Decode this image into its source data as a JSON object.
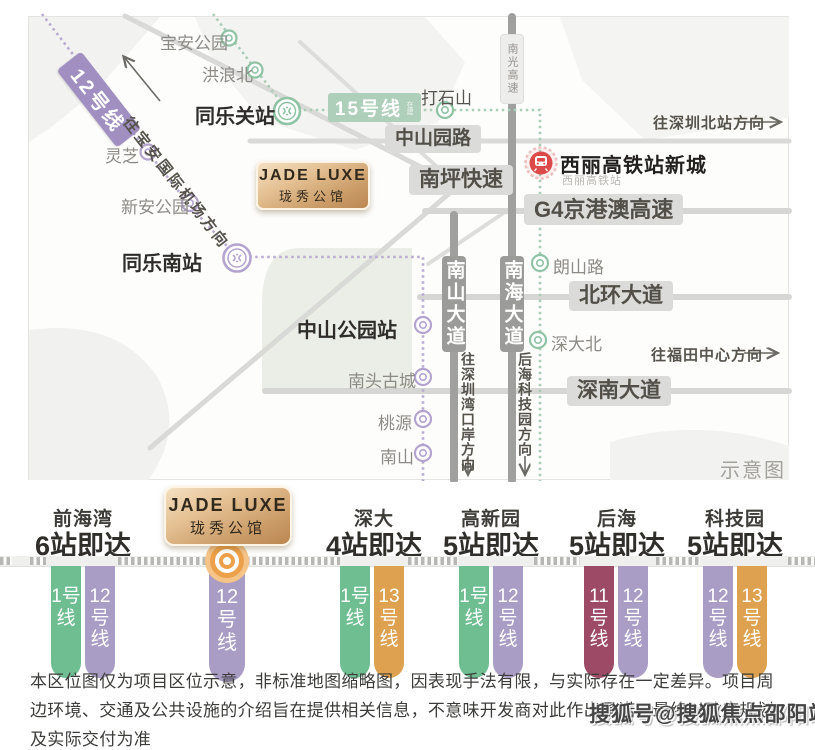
{
  "colors": {
    "line1_green": "#6fbe92",
    "line12_purple": "#a99cc5",
    "line11_maroon": "#9d4a66",
    "line13_orange": "#dda14f",
    "line15_chip_green": "#aecfb9",
    "line12_band_purple": "#a08fc0",
    "marker_orange": "#eca049",
    "gold_badge": "#cb9d69",
    "hsr_red": "#dc4a4a",
    "road_gray": "#9b9b99"
  },
  "brand": {
    "name_en": "JADE LUXE",
    "name_cn": "珑秀公馆"
  },
  "map": {
    "note": "示意图",
    "line12_band": "12号线",
    "line15_chip": "15号线",
    "line15_sub": "在建",
    "hsr": {
      "title": "西丽高铁站新城",
      "sub": "西丽高铁站"
    },
    "stations": [
      {
        "name": "宝安公园"
      },
      {
        "name": "洪浪北"
      },
      {
        "name": "同乐关站"
      },
      {
        "name": "打石山"
      },
      {
        "name": "灵芝"
      },
      {
        "name": "新安公园"
      },
      {
        "name": "同乐南站"
      },
      {
        "name": "中山公园站"
      },
      {
        "name": "南头古城"
      },
      {
        "name": "桃源"
      },
      {
        "name": "南山"
      },
      {
        "name": "朗山路"
      },
      {
        "name": "深大北"
      }
    ],
    "roads": [
      {
        "name": "中山园路"
      },
      {
        "name": "南坪快速"
      },
      {
        "name": "G4京港澳高速"
      },
      {
        "name": "北环大道"
      },
      {
        "name": "深南大道"
      },
      {
        "name": "南山大道"
      },
      {
        "name": "南海大道"
      },
      {
        "name": "南光高速"
      }
    ],
    "directions": {
      "airport": "往宝安国际机场方向",
      "north_station": "往深圳北站方向",
      "futian": "往福田中心方向",
      "bay_port": "往深圳湾口岸方向",
      "houhai_tech": "后海科技园方向"
    }
  },
  "transit": {
    "groups": [
      {
        "name": "前海湾",
        "count": "6站即达",
        "pills": [
          {
            "label": "1号线"
          },
          {
            "label": "12号线"
          }
        ]
      },
      {
        "name": "深大",
        "count": "4站即达",
        "pills": [
          {
            "label": "1号线"
          },
          {
            "label": "13号线"
          }
        ]
      },
      {
        "name": "高新园",
        "count": "5站即达",
        "pills": [
          {
            "label": "1号线"
          },
          {
            "label": "12号线"
          }
        ]
      },
      {
        "name": "后海",
        "count": "5站即达",
        "pills": [
          {
            "label": "11号线"
          },
          {
            "label": "12号线"
          }
        ]
      },
      {
        "name": "科技园",
        "count": "5站即达",
        "pills": [
          {
            "label": "12号线"
          },
          {
            "label": "13号线"
          }
        ]
      }
    ],
    "project_pill": {
      "label": "12号线"
    }
  },
  "disclaimer": {
    "line1": "本区位图仅为项目区位示意，非标准地图缩略图，因表现手法有限，与实际存在一定差异。项目周",
    "line2": "边环境、交通及公共设施的介绍旨在提供相关信息，不意味开发商对此作出承诺，最终以政府规划",
    "line3": "及实际交付为准"
  },
  "watermark": "搜狐号@搜狐焦点邵阳站"
}
